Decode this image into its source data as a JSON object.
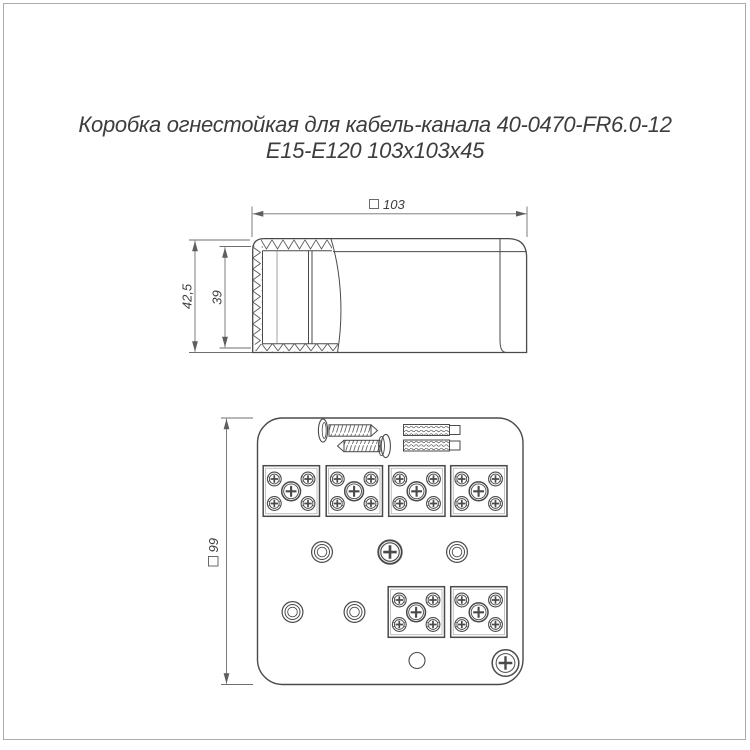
{
  "title": {
    "line1": "Коробка огнестойкая для кабель-канала 40-0470-FR6.0-12",
    "line2": "Е15-Е120 103х103х45"
  },
  "side_view": {
    "dim_width": "103",
    "dim_outer_height": "42,5",
    "dim_inner_height": "39"
  },
  "bottom_view": {
    "dim_size": "99",
    "screw_count": 2,
    "anchor_count": 2,
    "terminal_block_count": 6,
    "mounting_hole_count": 4
  },
  "colors": {
    "line": "#4a4a4a",
    "dim_line": "#6e6e6e",
    "text": "#3d3d3d",
    "frame_border": "#ababab"
  }
}
